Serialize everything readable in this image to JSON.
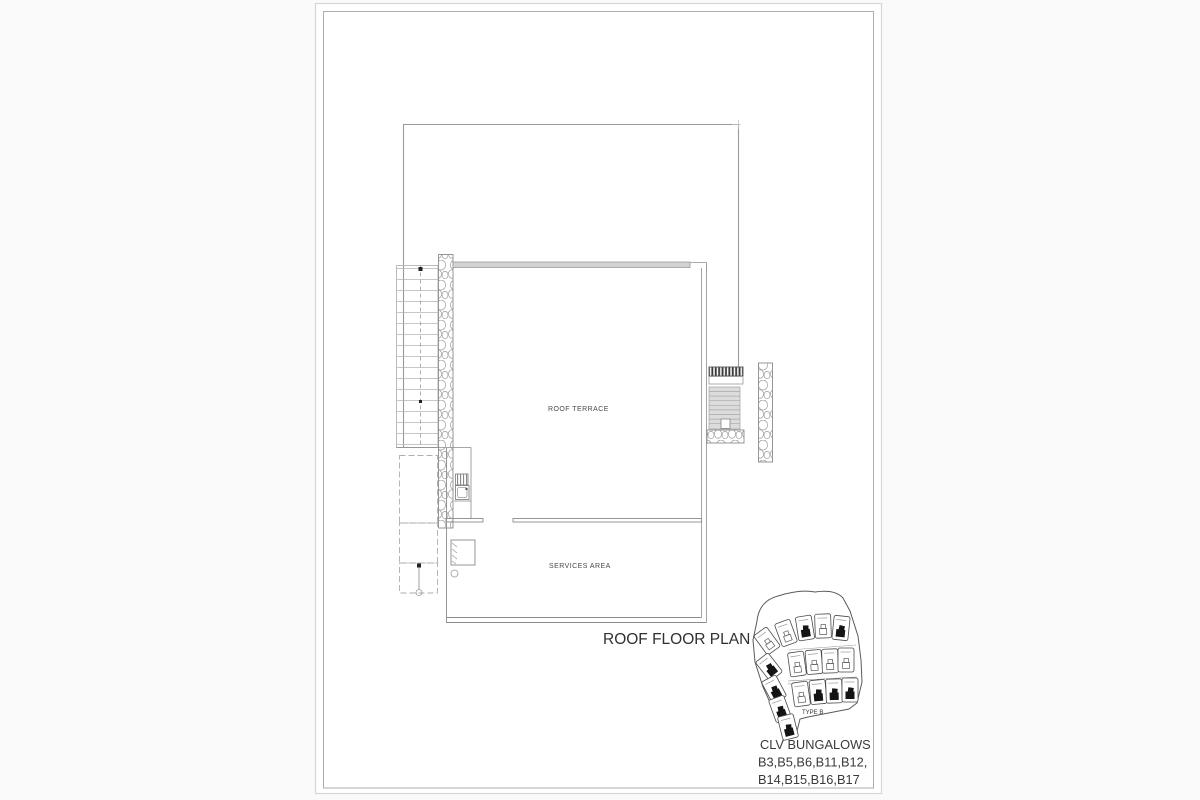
{
  "sheet": {
    "title": "ROOF FLOOR PLAN",
    "room_labels": {
      "roof_terrace": "ROOF TERRACE",
      "services_area": "SERVICES AREA"
    }
  },
  "key_plan": {
    "type_label": "TYPE B",
    "caption": [
      "CLV BUNGALOWS",
      "B3,B5,B6,B11,B12,",
      "B14,B15,B16,B17"
    ],
    "highlighted_unit_count": 9
  },
  "colors": {
    "paper": "#ffffff",
    "canvas_background": "#fafafa",
    "wall_line": "#8c8c8c",
    "light_line": "#b4b4b4",
    "parapet_fill": "#d2d2d2",
    "steps_fill": "#dcdcdc",
    "louver_dark": "#3a3a3a",
    "highlight_black": "#141414",
    "text": "#3d3d3d"
  }
}
